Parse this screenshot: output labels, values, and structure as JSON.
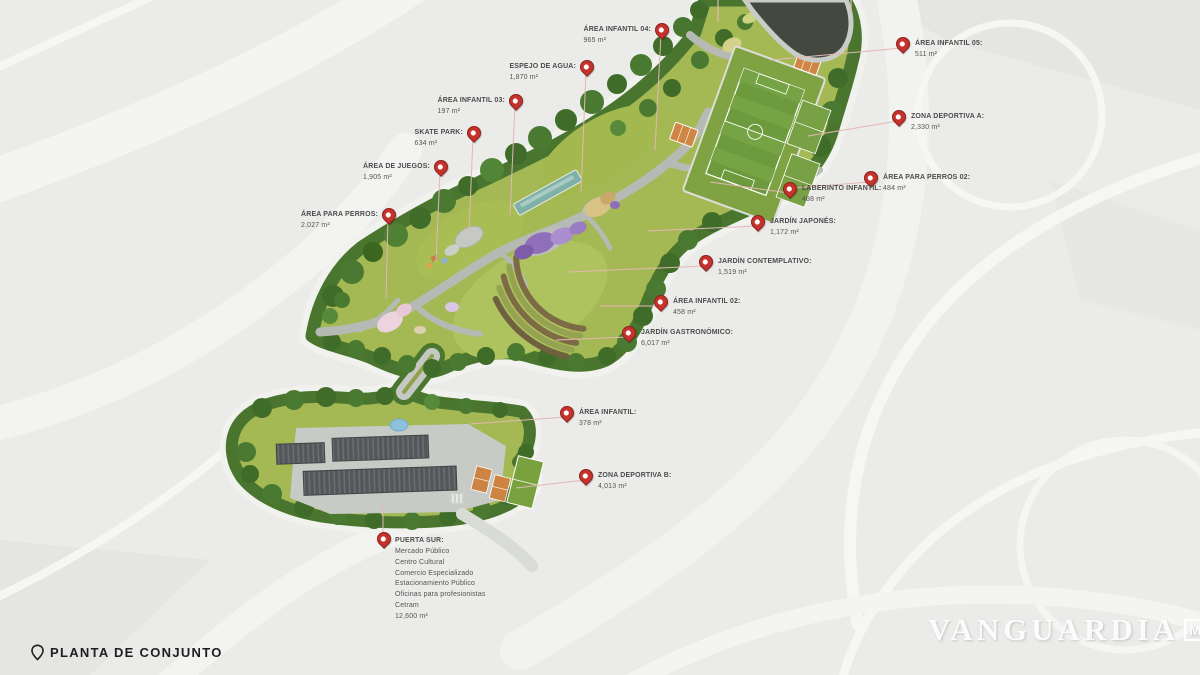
{
  "page": {
    "footer_label": "PLANTA DE CONJUNTO",
    "watermark": "VANGUARDIA",
    "watermark_suffix": "MX"
  },
  "colors": {
    "pin_red": "#c5332d",
    "leader_pink": "#e2b7b7",
    "lawn_green": "#a4b853",
    "tree_green": "#49752f",
    "pond_dark": "#44493f",
    "building_gray": "#53575a",
    "court_orange": "#cf8644",
    "water_teal": "#7fb0aa",
    "garden_purple": "#8f6fba",
    "background_gray": "#ebebe9"
  },
  "map": {
    "pins": [
      {
        "label": "ÁREA INFANTIL 04:",
        "area": "965 m²",
        "x": 661,
        "y": 34,
        "tx": 655,
        "ty": 150,
        "side": "left"
      },
      {
        "label": "ESPEJO DE AGUA:",
        "area": "1,870 m²",
        "x": 586,
        "y": 71,
        "tx": 581,
        "ty": 192,
        "side": "left"
      },
      {
        "label": "ÁREA INFANTIL 03:",
        "area": "197 m²",
        "x": 515,
        "y": 105,
        "tx": 510,
        "ty": 215,
        "side": "left"
      },
      {
        "label": "SKATE PARK:",
        "area": "634 m²",
        "x": 473,
        "y": 137,
        "tx": 469,
        "ty": 233,
        "side": "left"
      },
      {
        "label": "ÁREA DE JUEGOS:",
        "area": "1,905 m²",
        "x": 440,
        "y": 171,
        "tx": 436,
        "ty": 262,
        "side": "left"
      },
      {
        "label": "ÁREA PARA PERROS:",
        "area": "2,027 m²",
        "x": 388,
        "y": 219,
        "tx": 386,
        "ty": 298,
        "side": "left"
      },
      {
        "label": "ÁREA INFANTIL 05:",
        "area": "511 m²",
        "x": 902,
        "y": 48,
        "tx": 770,
        "ty": 60,
        "side": "right"
      },
      {
        "label": "ZONA DEPORTIVA A:",
        "area": "2,330 m²",
        "x": 898,
        "y": 121,
        "tx": 808,
        "ty": 136,
        "side": "right"
      },
      {
        "label": "ÁREA PARA PERROS 02:",
        "area": "484 m²",
        "x": 870,
        "y": 182,
        "tx": 792,
        "ty": 188,
        "side": "right"
      },
      {
        "label": "LABERINTO INFANTIL:",
        "area": "488 m²",
        "x": 789,
        "y": 193,
        "tx": 710,
        "ty": 182,
        "side": "right"
      },
      {
        "label": "JARDÍN JAPONÉS:",
        "area": "1,172 m²",
        "x": 757,
        "y": 226,
        "tx": 648,
        "ty": 231,
        "side": "right"
      },
      {
        "label": "JARDÍN CONTEMPLATIVO:",
        "area": "1,519 m²",
        "x": 705,
        "y": 266,
        "tx": 568,
        "ty": 272,
        "side": "right"
      },
      {
        "label": "ÁREA INFANTIL 02:",
        "area": "458 m²",
        "x": 660,
        "y": 306,
        "tx": 600,
        "ty": 306,
        "side": "right"
      },
      {
        "label": "JARDÍN GASTRONÓMICO:",
        "area": "6,017 m²",
        "x": 628,
        "y": 337,
        "tx": 556,
        "ty": 340,
        "side": "right"
      },
      {
        "label": "ÁREA INFANTIL:",
        "area": "378 m²",
        "x": 566,
        "y": 417,
        "tx": 470,
        "ty": 424,
        "side": "right"
      },
      {
        "label": "ZONA DEPORTIVA B:",
        "area": "4,013 m²",
        "x": 585,
        "y": 480,
        "tx": 516,
        "ty": 488,
        "side": "right"
      },
      {
        "label": "PUERTA SUR:",
        "area": "",
        "lines": [
          "Mercado Público",
          "Centro Cultural",
          "Comercio Especializado",
          "Estacionamiento Público",
          "Oficinas para profesionistas",
          "Cetram",
          "12,600 m²"
        ],
        "x": 383,
        "y": 543,
        "tx": 383,
        "ty": 504,
        "side": "bottom"
      }
    ]
  }
}
